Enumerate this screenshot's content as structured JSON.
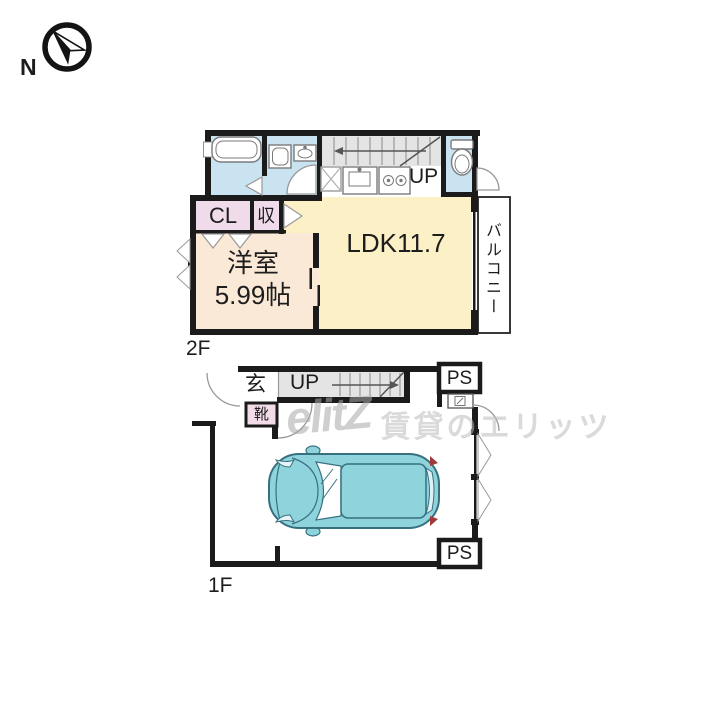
{
  "compass": {
    "north_label": "N"
  },
  "watermark": {
    "logo_text": "elitZ",
    "brand_text": "賃貸のエリッツ"
  },
  "floor_2f": {
    "name_label": "2F",
    "stairs_label": "UP",
    "rooms": {
      "living": {
        "label": "LDK11.7"
      },
      "bedroom": {
        "name": "洋室",
        "size": "5.99帖"
      },
      "closet": {
        "label": "CL"
      },
      "storage": {
        "label": "収"
      },
      "balcony": {
        "label": "バルコニー"
      }
    },
    "fixtures": [
      "bathtub",
      "washing-machine",
      "washbasin",
      "kitchen-sink",
      "gas-stove",
      "toilet"
    ]
  },
  "floor_1f": {
    "name_label": "1F",
    "stairs_label": "UP",
    "rooms": {
      "entrance": {
        "label": "玄"
      },
      "shoe_cabinet": {
        "label": "靴"
      },
      "pipe_space_top": {
        "label": "PS"
      },
      "pipe_space_bottom": {
        "label": "PS"
      }
    },
    "fixtures": [
      "car-top-view",
      "utility-meter"
    ]
  },
  "colors": {
    "wall": "#1b1b1b",
    "wet_area_blue": "#C9E3F1",
    "closet_pink": "#F0DBEB",
    "bedroom_peach": "#FAE9D6",
    "ldk_yellow": "#FBF0C6",
    "stairs_gray": "#E4E4E4",
    "car_teal": "#8FD3DC",
    "car_outline": "#37717F"
  }
}
